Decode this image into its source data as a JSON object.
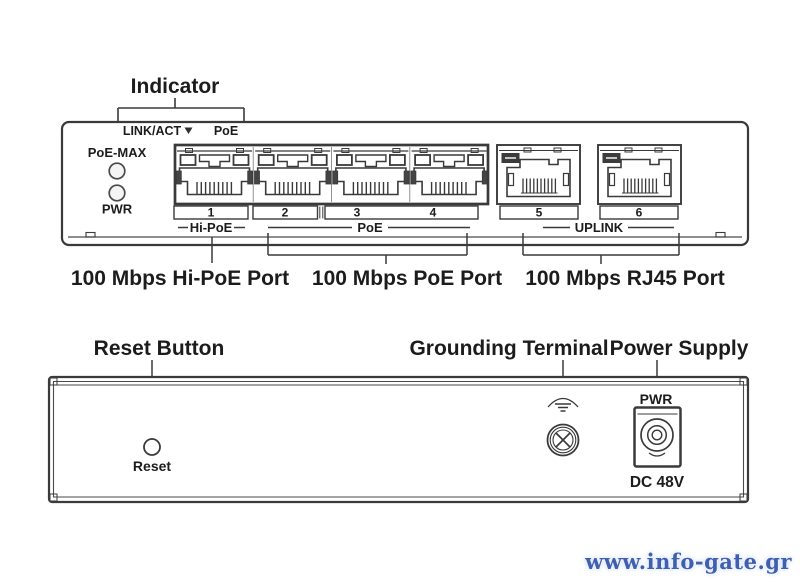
{
  "front": {
    "indicator_label": "Indicator",
    "led_legend": {
      "link_act": "LINK/ACT",
      "poe": "PoE"
    },
    "status_leds": {
      "poe_max": "PoE-MAX",
      "pwr": "PWR"
    },
    "port_numbers": [
      "1",
      "2",
      "3",
      "4",
      "5",
      "6"
    ],
    "port_groups": {
      "hi_poe": "Hi-PoE",
      "poe": "PoE",
      "uplink": "UPLINK"
    },
    "captions": {
      "hi_poe": "100 Mbps Hi-PoE Port",
      "poe": "100 Mbps PoE Port",
      "rj45": "100 Mbps RJ45 Port"
    }
  },
  "rear": {
    "reset_callout": "Reset Button",
    "grounding_callout": "Grounding Terminal",
    "power_callout": "Power Supply",
    "pwr_label": "PWR",
    "reset_label": "Reset",
    "dc_label": "DC 48V"
  },
  "watermark": {
    "text": "www.info-gate.gr",
    "color": "#3f5fb0"
  },
  "colors": {
    "line": "#3a3a3a",
    "text": "#1c1c1c"
  }
}
